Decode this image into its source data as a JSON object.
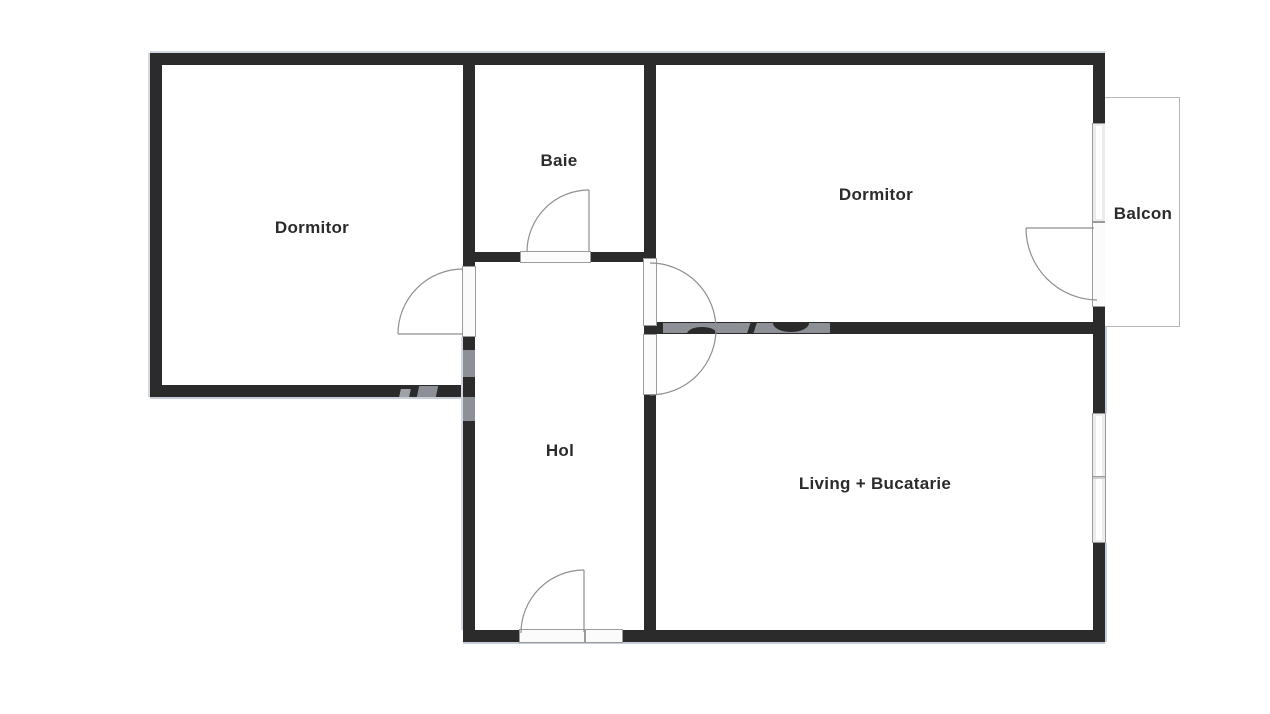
{
  "rooms": [
    {
      "id": "dormitor-left",
      "label": "Dormitor"
    },
    {
      "id": "baie",
      "label": "Baie"
    },
    {
      "id": "dormitor-right",
      "label": "Dormitor"
    },
    {
      "id": "balcon",
      "label": "Balcon"
    },
    {
      "id": "hol",
      "label": "Hol"
    },
    {
      "id": "living-bucatarie",
      "label": "Living + Bucatarie"
    }
  ],
  "colors": {
    "background": "#ffffff",
    "wall": "#2b2b2b",
    "label_text": "#2b2b2b",
    "door_swing_line": "#8f8f8f",
    "opening_outline": "#9b9b9b",
    "balcony_outline": "#b6b6b6",
    "watermark_gray": "#8d9096"
  }
}
